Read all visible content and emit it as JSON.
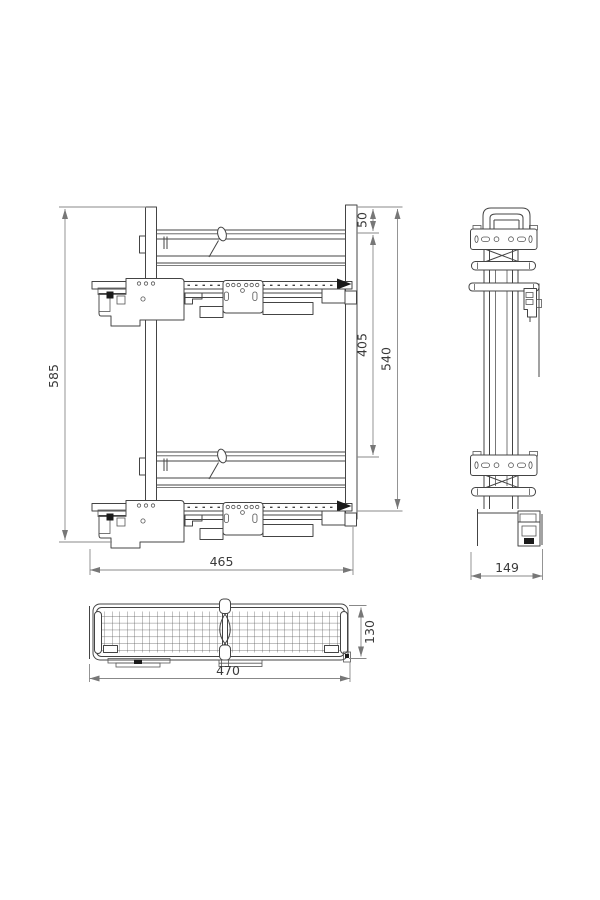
{
  "colors": {
    "background": "#ffffff",
    "drawing_line": "#444444",
    "dimension_line": "#888888",
    "label_text": "#3a3a3a",
    "filled_detail": "#1a1a1a"
  },
  "dimensions": {
    "total_height": "585",
    "top_gap": "50",
    "rail_span": "405",
    "frame_height": "540",
    "side_depth": "465",
    "front_width": "149",
    "basket_length": "470",
    "basket_depth": "130"
  }
}
